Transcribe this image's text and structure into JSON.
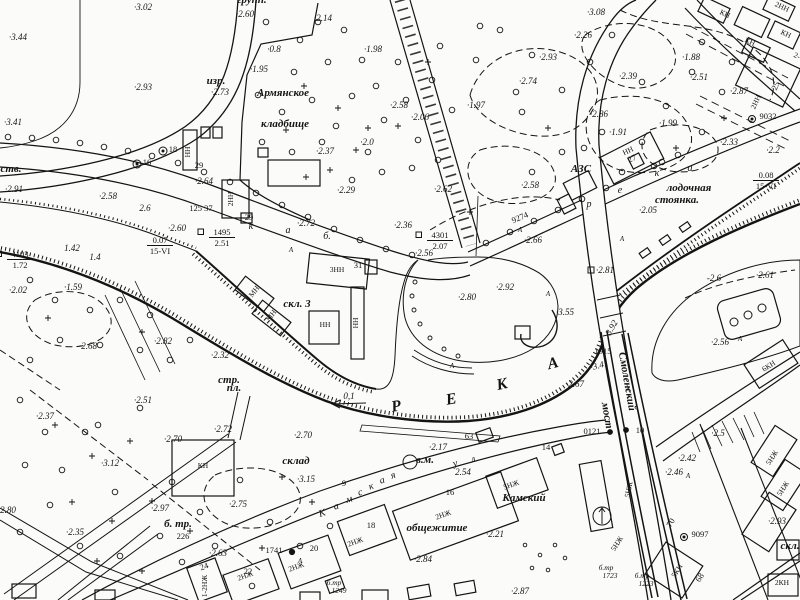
{
  "map": {
    "ink_color": "#141414",
    "paper_color": "#fbfbf9",
    "labels": {
      "places": [
        {
          "t": "Армянское",
          "x": 283,
          "y": 96,
          "s": 11.5
        },
        {
          "t": "кладбище",
          "x": 285,
          "y": 127,
          "s": 11.5
        },
        {
          "t": "АЗС",
          "x": 581,
          "y": 172,
          "s": 11
        },
        {
          "t": "лодочная",
          "x": 689,
          "y": 191,
          "s": 10.5
        },
        {
          "t": "стоянка.",
          "x": 677,
          "y": 203,
          "s": 10.5
        },
        {
          "t": "склад",
          "x": 296,
          "y": 464,
          "s": 11
        },
        {
          "t": "общежитие",
          "x": 437,
          "y": 531,
          "s": 11
        },
        {
          "t": "Камский",
          "x": 524,
          "y": 501,
          "s": 12
        },
        {
          "t": "Смоленский",
          "x": 624,
          "y": 382,
          "s": 11,
          "r": 80
        },
        {
          "t": "мост",
          "x": 604,
          "y": 416,
          "s": 11,
          "r": 80
        },
        {
          "t": "изр.",
          "x": 216,
          "y": 84,
          "s": 8.5
        },
        {
          "t": "ств.",
          "x": 11,
          "y": 172,
          "s": 8.5
        },
        {
          "t": "скл. 3",
          "x": 297,
          "y": 307,
          "s": 8
        },
        {
          "t": "скл.",
          "x": 790,
          "y": 549,
          "s": 8
        },
        {
          "t": "б. тр.",
          "x": 178,
          "y": 527,
          "s": 8.5
        },
        {
          "t": "в.м.",
          "x": 425,
          "y": 463,
          "s": 9
        },
        {
          "t": "стр.",
          "x": 229,
          "y": 383,
          "s": 7
        },
        {
          "t": "пл.",
          "x": 234,
          "y": 391,
          "s": 7
        },
        {
          "t": "групп.",
          "x": 252,
          "y": 3,
          "s": 9
        }
      ],
      "utility_booths": [
        {
          "t": "б.тр",
          "x": 334,
          "y": 585
        },
        {
          "t": "1249",
          "x": 339,
          "y": 593
        },
        {
          "t": "б.тр",
          "x": 606,
          "y": 570
        },
        {
          "t": "1723",
          "x": 610,
          "y": 578
        },
        {
          "t": "б.тр",
          "x": 642,
          "y": 578
        },
        {
          "t": "1223",
          "x": 646,
          "y": 586
        }
      ],
      "street_letters": [
        {
          "t": "К",
          "x": 323,
          "y": 516,
          "r": -18
        },
        {
          "t": "а",
          "x": 337,
          "y": 509,
          "r": -18
        },
        {
          "t": "м",
          "x": 350,
          "y": 502,
          "r": -18
        },
        {
          "t": "с",
          "x": 361,
          "y": 495,
          "r": -18
        },
        {
          "t": "к",
          "x": 372,
          "y": 489,
          "r": -18
        },
        {
          "t": "а",
          "x": 383,
          "y": 483,
          "r": -18
        },
        {
          "t": "я",
          "x": 394,
          "y": 478,
          "r": -18
        },
        {
          "t": "у",
          "x": 456,
          "y": 466,
          "r": -18
        },
        {
          "t": "л",
          "x": 474,
          "y": 462,
          "r": -18
        },
        {
          "t": "к",
          "x": 251,
          "y": 229
        },
        {
          "t": "а",
          "x": 288,
          "y": 233
        },
        {
          "t": "б.",
          "x": 327,
          "y": 239
        }
      ],
      "river_big": [
        {
          "t": "Р",
          "x": 397,
          "y": 411,
          "r": -10
        },
        {
          "t": "Е",
          "x": 452,
          "y": 404,
          "r": -10
        },
        {
          "t": "К",
          "x": 503,
          "y": 389,
          "r": -12
        },
        {
          "t": "А",
          "x": 554,
          "y": 368,
          "r": -14
        }
      ],
      "river_small": [
        {
          "t": "р",
          "x": 589,
          "y": 207
        },
        {
          "t": "е",
          "x": 620,
          "y": 193
        },
        {
          "t": "к",
          "x": 657,
          "y": 176
        },
        {
          "t": "а",
          "x": 690,
          "y": 171
        }
      ],
      "spot_heights": [
        {
          "t": "·3.02",
          "x": 143,
          "y": 10
        },
        {
          "t": "·3.44",
          "x": 18,
          "y": 40
        },
        {
          "t": "·2.60",
          "x": 245,
          "y": 17
        },
        {
          "t": "·2.93",
          "x": 143,
          "y": 90
        },
        {
          "t": "·2.73",
          "x": 220,
          "y": 95
        },
        {
          "t": "·3.41",
          "x": 13,
          "y": 125
        },
        {
          "t": "·2.91",
          "x": 14,
          "y": 192
        },
        {
          "t": "·2.14",
          "x": 323,
          "y": 21
        },
        {
          "t": "·0.8",
          "x": 274,
          "y": 52
        },
        {
          "t": "·1.95",
          "x": 259,
          "y": 72
        },
        {
          "t": "·1.98",
          "x": 373,
          "y": 52
        },
        {
          "t": "·2.37",
          "x": 325,
          "y": 154
        },
        {
          "t": "·2.29",
          "x": 346,
          "y": 193
        },
        {
          "t": "·2.58",
          "x": 399,
          "y": 108
        },
        {
          "t": "·2.06",
          "x": 420,
          "y": 120
        },
        {
          "t": "·2.0",
          "x": 367,
          "y": 145
        },
        {
          "t": "·3.08",
          "x": 596,
          "y": 15
        },
        {
          "t": "·2.26",
          "x": 583,
          "y": 38
        },
        {
          "t": "·2.93",
          "x": 548,
          "y": 60
        },
        {
          "t": "·2.74",
          "x": 528,
          "y": 84
        },
        {
          "t": "·1.97",
          "x": 476,
          "y": 108
        },
        {
          "t": "·1.88",
          "x": 691,
          "y": 60
        },
        {
          "t": "·2.39",
          "x": 628,
          "y": 79
        },
        {
          "t": "·2.51",
          "x": 699,
          "y": 80
        },
        {
          "t": "·2.87",
          "x": 739,
          "y": 94
        },
        {
          "t": "·2.86",
          "x": 599,
          "y": 117
        },
        {
          "t": "·1.99",
          "x": 668,
          "y": 126
        },
        {
          "t": "·1.91",
          "x": 618,
          "y": 135
        },
        {
          "t": "·2.33",
          "x": 729,
          "y": 145
        },
        {
          "t": "·2.2",
          "x": 773,
          "y": 153
        },
        {
          "t": "·2.62",
          "x": 443,
          "y": 192
        },
        {
          "t": "·2.58",
          "x": 530,
          "y": 188
        },
        {
          "t": "·2.36",
          "x": 403,
          "y": 228
        },
        {
          "t": "·2.66",
          "x": 533,
          "y": 243
        },
        {
          "t": "·2.56",
          "x": 424,
          "y": 256
        },
        {
          "t": "·2.92",
          "x": 505,
          "y": 290
        },
        {
          "t": "·2.80",
          "x": 467,
          "y": 300
        },
        {
          "t": "·2.81",
          "x": 605,
          "y": 273
        },
        {
          "t": "·3.55",
          "x": 565,
          "y": 315
        },
        {
          "t": "·2.05",
          "x": 648,
          "y": 213
        },
        {
          "t": "·2.61",
          "x": 765,
          "y": 278
        },
        {
          "t": "·2.56",
          "x": 720,
          "y": 345
        },
        {
          "t": "·2.67",
          "x": 575,
          "y": 387
        },
        {
          "t": "·2.17",
          "x": 438,
          "y": 450
        },
        {
          "t": "2.54",
          "x": 463,
          "y": 475
        },
        {
          "t": "·2.70",
          "x": 303,
          "y": 438
        },
        {
          "t": "·3.15",
          "x": 306,
          "y": 482
        },
        {
          "t": "·2.75",
          "x": 238,
          "y": 507
        },
        {
          "t": "·2.84",
          "x": 423,
          "y": 562
        },
        {
          "t": "·2.21",
          "x": 495,
          "y": 537
        },
        {
          "t": "·2.87",
          "x": 520,
          "y": 594
        },
        {
          "t": "·2.5",
          "x": 718,
          "y": 436
        },
        {
          "t": "·2.42",
          "x": 687,
          "y": 461
        },
        {
          "t": "·2.46",
          "x": 674,
          "y": 475
        },
        {
          "t": "·2.93",
          "x": 777,
          "y": 524
        },
        {
          "t": "·2.64",
          "x": 204,
          "y": 184
        },
        {
          "t": "·2.58",
          "x": 108,
          "y": 199
        },
        {
          "t": "2.6",
          "x": 145,
          "y": 211
        },
        {
          "t": "·2.60",
          "x": 177,
          "y": 231
        },
        {
          "t": "·2.02",
          "x": 18,
          "y": 293
        },
        {
          "t": "·1.59",
          "x": 73,
          "y": 290
        },
        {
          "t": "1.42",
          "x": 72,
          "y": 251
        },
        {
          "t": "1.4",
          "x": 95,
          "y": 260
        },
        {
          "t": "·2.68",
          "x": 88,
          "y": 349
        },
        {
          "t": "·2.82",
          "x": 163,
          "y": 344
        },
        {
          "t": "·2.32",
          "x": 220,
          "y": 358
        },
        {
          "t": "2.80",
          "x": 8,
          "y": 513
        },
        {
          "t": "·2.35",
          "x": 75,
          "y": 535
        },
        {
          "t": "·2.97",
          "x": 160,
          "y": 511
        },
        {
          "t": "·3.12",
          "x": 110,
          "y": 466
        },
        {
          "t": "·2.51",
          "x": 143,
          "y": 403
        },
        {
          "t": "·2.37",
          "x": 45,
          "y": 419
        },
        {
          "t": "·2.70",
          "x": 173,
          "y": 442
        },
        {
          "t": "·2.72",
          "x": 223,
          "y": 432
        },
        {
          "t": "·2.72",
          "x": 306,
          "y": 226
        },
        {
          "t": "·2.63",
          "x": 218,
          "y": 556
        },
        {
          "t": "·3.41",
          "x": 600,
          "y": 368,
          "r": -15
        },
        {
          "t": "3.92",
          "x": 614,
          "y": 329,
          "r": -60
        },
        {
          "t": "-2.6",
          "x": 714,
          "y": 281
        }
      ],
      "point_numbers": [
        {
          "t": "9274",
          "x": 521,
          "y": 220,
          "r": -23
        },
        {
          "t": "125 37.",
          "x": 202,
          "y": 211
        },
        {
          "t": "29",
          "x": 199,
          "y": 168
        },
        {
          "t": "29",
          "x": 249,
          "y": 220
        },
        {
          "t": "31",
          "x": 358,
          "y": 268
        },
        {
          "t": "27",
          "x": 633,
          "y": 161,
          "r": -25
        },
        {
          "t": "16",
          "x": 450,
          "y": 495
        },
        {
          "t": "18",
          "x": 371,
          "y": 528
        },
        {
          "t": "20",
          "x": 314,
          "y": 551
        },
        {
          "t": "22",
          "x": 248,
          "y": 574
        },
        {
          "t": "24",
          "x": 205,
          "y": 569,
          "r": -20
        },
        {
          "t": "25",
          "x": 778,
          "y": 87,
          "r": -65
        },
        {
          "t": "63",
          "x": 469,
          "y": 439
        },
        {
          "t": "0121",
          "x": 592,
          "y": 434
        },
        {
          "t": "10",
          "x": 640,
          "y": 433
        },
        {
          "t": "1741",
          "x": 274,
          "y": 553
        },
        {
          "t": "9032",
          "x": 768,
          "y": 119
        },
        {
          "t": "9097",
          "x": 700,
          "y": 537
        },
        {
          "t": "70",
          "x": 673,
          "y": 524,
          "r": -60
        },
        {
          "t": "68",
          "x": 702,
          "y": 579,
          "r": -57
        },
        {
          "t": "1915",
          "x": 603,
          "y": 354
        },
        {
          "t": "226",
          "x": 183,
          "y": 539
        },
        {
          "t": "14",
          "x": 546,
          "y": 450
        },
        {
          "t": "18",
          "x": 173,
          "y": 152
        },
        {
          "t": "16",
          "x": 147,
          "y": 165
        },
        {
          "t": "9",
          "x": 344,
          "y": 486
        }
      ],
      "building_labels": [
        {
          "t": "КН",
          "x": 203,
          "y": 468,
          "s": 10
        },
        {
          "t": "НН",
          "x": 190,
          "y": 152,
          "r": -90
        },
        {
          "t": "2НН",
          "x": 233,
          "y": 199,
          "r": -90
        },
        {
          "t": "3НН",
          "x": 337,
          "y": 272
        },
        {
          "t": "МН",
          "x": 256,
          "y": 293,
          "r": -52
        },
        {
          "t": "МН",
          "x": 273,
          "y": 317,
          "r": -52
        },
        {
          "t": "НН",
          "x": 325,
          "y": 327
        },
        {
          "t": "НН",
          "x": 358,
          "y": 323,
          "r": -90
        },
        {
          "t": "НН",
          "x": 629,
          "y": 153,
          "r": -26
        },
        {
          "t": "2НЖ",
          "x": 444,
          "y": 517,
          "r": -20
        },
        {
          "t": "2НЖ",
          "x": 356,
          "y": 544,
          "r": -20
        },
        {
          "t": "2НЖ",
          "x": 297,
          "y": 569,
          "r": -20
        },
        {
          "t": "2НЖ",
          "x": 246,
          "y": 578,
          "r": -20
        },
        {
          "t": "1-2НЖ",
          "x": 207,
          "y": 586,
          "r": -90
        },
        {
          "t": "5НЖ",
          "x": 512,
          "y": 487,
          "r": -20
        },
        {
          "t": "5НЖ",
          "x": 631,
          "y": 490,
          "r": -78
        },
        {
          "t": "5НЖ",
          "x": 619,
          "y": 545,
          "r": -57
        },
        {
          "t": "5НЖ",
          "x": 774,
          "y": 459,
          "r": -57
        },
        {
          "t": "5НЖ",
          "x": 785,
          "y": 490,
          "r": -57
        },
        {
          "t": "5КН",
          "x": 679,
          "y": 572,
          "r": -57
        },
        {
          "t": "2КН",
          "x": 782,
          "y": 585
        },
        {
          "t": "6КН",
          "x": 770,
          "y": 368,
          "r": -33
        },
        {
          "t": "КН",
          "x": 724,
          "y": 16,
          "r": 25
        },
        {
          "t": "2НН",
          "x": 781,
          "y": 9,
          "r": 25
        },
        {
          "t": "КН",
          "x": 785,
          "y": 36,
          "r": 25
        },
        {
          "t": "КН",
          "x": 749,
          "y": 44,
          "r": 25
        },
        {
          "t": "2НН",
          "x": 758,
          "y": 103,
          "r": -65
        },
        {
          "t": "2-",
          "x": 796,
          "y": 58,
          "r": 25
        }
      ],
      "surface_marks": [
        {
          "t": "А",
          "x": 291,
          "y": 252
        },
        {
          "t": "А",
          "x": 548,
          "y": 296
        },
        {
          "t": "А",
          "x": 628,
          "y": 392
        },
        {
          "t": "А",
          "x": 452,
          "y": 368
        },
        {
          "t": "А",
          "x": 622,
          "y": 241
        },
        {
          "t": "А",
          "x": 688,
          "y": 478
        },
        {
          "t": "А",
          "x": 740,
          "y": 341
        },
        {
          "t": "А",
          "x": 300,
          "y": 563
        },
        {
          "t": "А",
          "x": 520,
          "y": 232
        }
      ]
    },
    "water_edge_marks": [
      {
        "top": "0.07",
        "bottom": "15-VI",
        "x": 160,
        "y": 243
      },
      {
        "top": "0.08",
        "bottom": "15-VI",
        "x": 766,
        "y": 178
      }
    ],
    "benchmarks": [
      {
        "no": "4301",
        "elev": "2.07",
        "x": 440,
        "y": 238
      },
      {
        "no": "4103",
        "elev": "1.72",
        "x": 20,
        "y": 257
      },
      {
        "no": "1495",
        "elev": "2.51",
        "x": 222,
        "y": 235
      }
    ],
    "flow_arrow": {
      "t": "0,1",
      "x": 349,
      "y": 399
    }
  }
}
